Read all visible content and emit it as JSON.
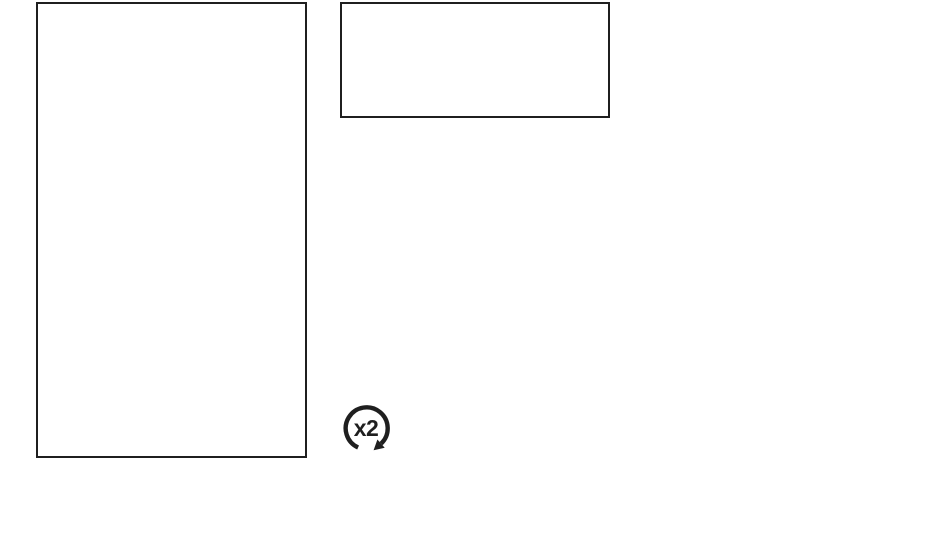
{
  "canvas": {
    "background_color": "#ffffff",
    "stroke_color": "#1f1f1f"
  },
  "frames": [
    {
      "name": "tall-frame"
    },
    {
      "name": "wide-frame"
    }
  ],
  "loop_icon": {
    "label": "x2",
    "meaning": "repeat-twice"
  }
}
